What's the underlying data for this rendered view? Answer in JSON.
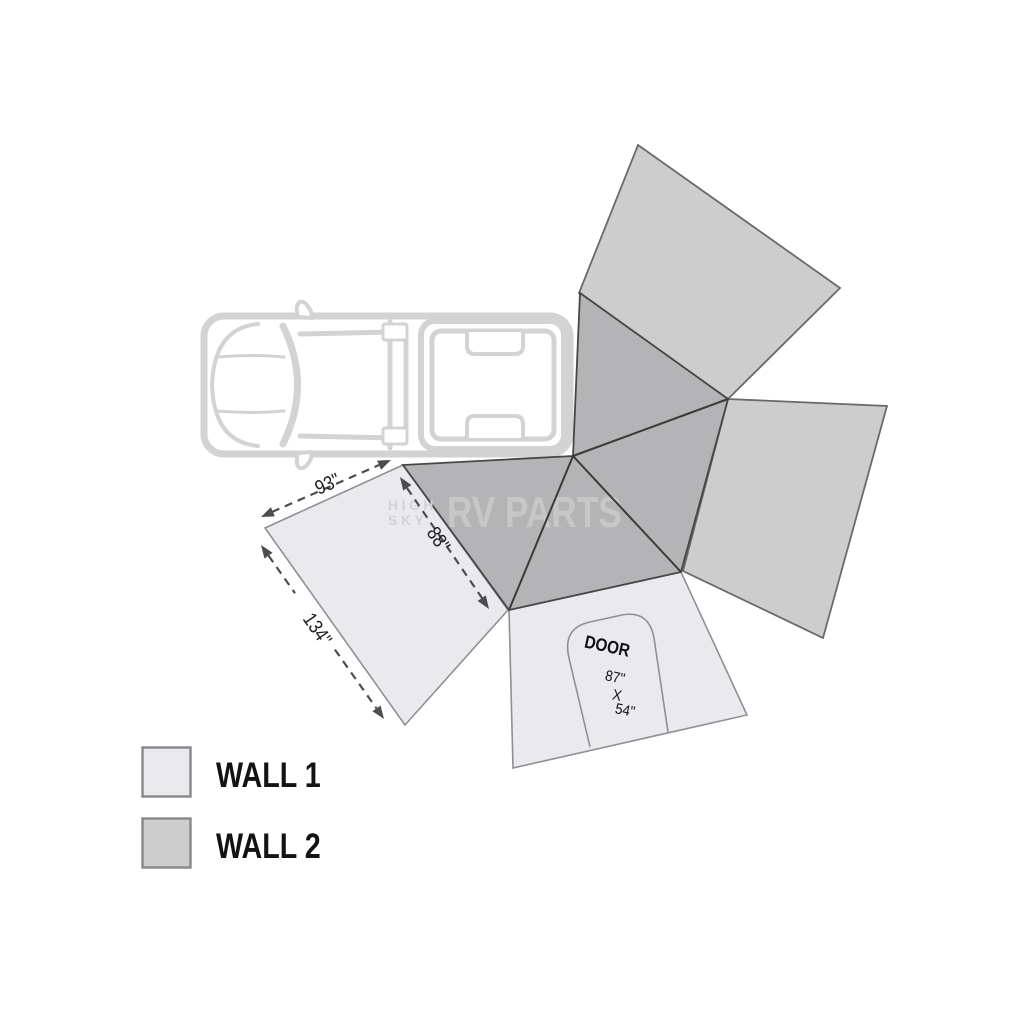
{
  "legend": {
    "items": [
      {
        "id": "wall1",
        "label": "WALL 1"
      },
      {
        "id": "wall2",
        "label": "WALL 2"
      }
    ]
  },
  "dimensions": {
    "edge_top": "93\"",
    "edge_depth": "88\"",
    "edge_side": "134\""
  },
  "door": {
    "label": "DOOR",
    "height": "87\"",
    "separator": "X",
    "width": "54\""
  },
  "watermark": {
    "small_top": "HIGH",
    "small_bottom": "SKY",
    "brand": "RV PARTS"
  },
  "colors": {
    "wall1": "#e9e9ee",
    "wall2": "#cdcdce",
    "awning": "#b4b4b6",
    "truck_line": "#d3d3d3",
    "dim_line": "#4d4d4d",
    "crease": "#3a3a3a",
    "watermark": "#c7c7c7"
  }
}
